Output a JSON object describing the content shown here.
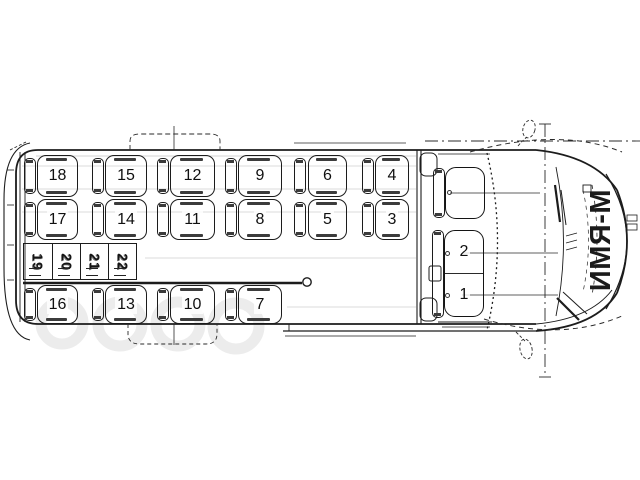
{
  "brand": {
    "text": "ИМЯ-М"
  },
  "seats": {
    "row_window": [
      "18",
      "15",
      "12",
      "9",
      "6",
      "4"
    ],
    "row_middle": [
      "17",
      "14",
      "11",
      "8",
      "5",
      "3"
    ],
    "row_folding": [
      "19",
      "20",
      "21",
      "22"
    ],
    "row_door": [
      "16",
      "13",
      "10",
      "7"
    ],
    "cab": [
      "2",
      "1"
    ]
  }
}
